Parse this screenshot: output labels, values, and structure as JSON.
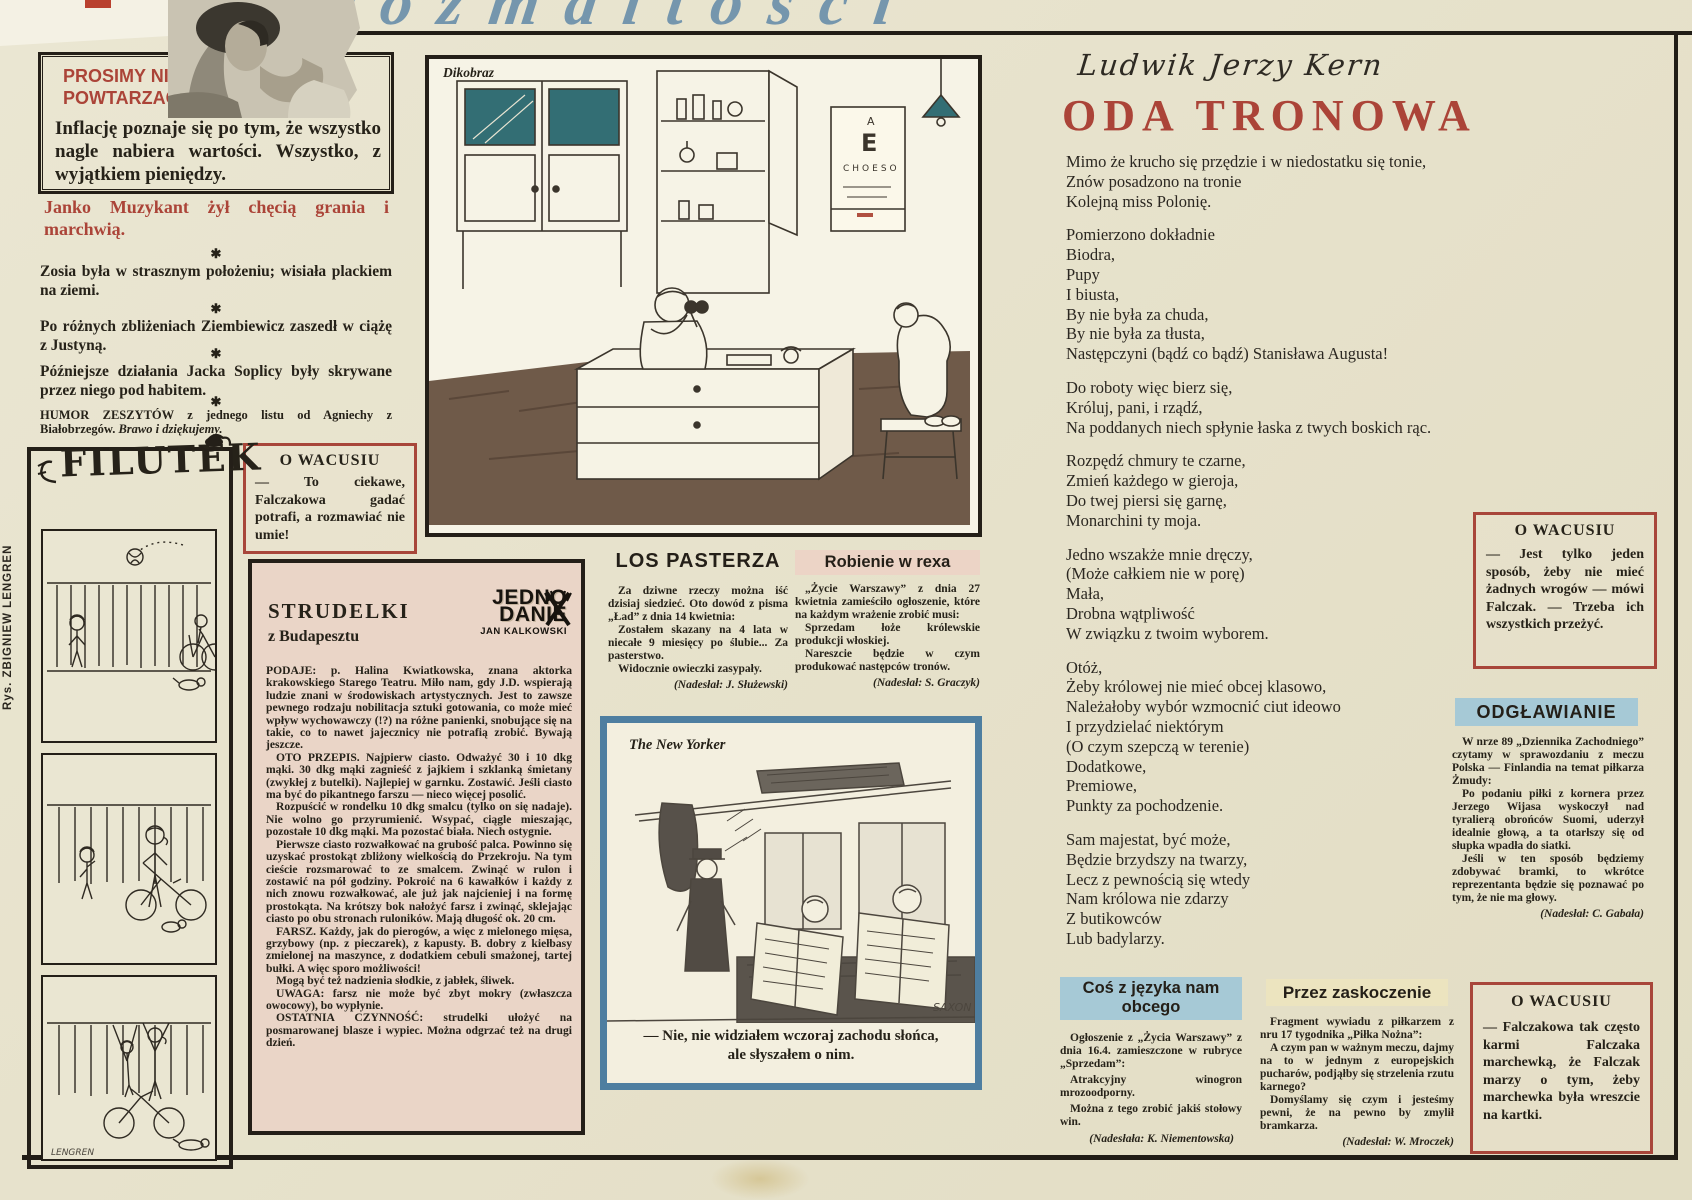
{
  "masthead": {
    "script": "rozmaitości"
  },
  "prosimy": {
    "title_line1": "PROSIMY NIE",
    "title_line2": "POWTARZAĆ.",
    "body": "Inflację poznaje się po tym, że wszystko nagle nabiera wartości. Wszystko, z wyjątkiem pieniędzy."
  },
  "janko": {
    "text": "Janko Muzykant żył chęcią grania i marchwią."
  },
  "aphorisms": {
    "separator": "✱",
    "items": [
      "Zosia była w strasznym położeniu; wisiała plackiem na ziemi.",
      "Po różnych zbliżeniach Ziembiewicz zaszedł w ciążę z Justyną.",
      "Późniejsze działania Jacka Soplicy były skrywane przez niego pod habitem."
    ]
  },
  "humor": {
    "text_bold": "HUMOR ZESZYTÓW z jednego listu od Agniechy z Białobrzegów.",
    "text_italic": "Brawo i dziękujemy."
  },
  "wacusiu1": {
    "title": "O WACUSIU",
    "body": "— To ciekawe, Falczakowa gadać potrafi, a rozmawiać nie umie!"
  },
  "filutek": {
    "logo": "FILUTEK",
    "artist": "Rys. ZBIGNIEW LENGREN",
    "signature": "LENGREN"
  },
  "strudelki": {
    "title": "STRUDELKI",
    "subtitle": "z Budapesztu",
    "logo_line1": "JEDNO",
    "logo_line2": "DANIE",
    "logo_byline": "JAN KALKOWSKI",
    "paragraphs": [
      "PODAJE: p. Halina Kwiatkowska, znana aktorka krakowskiego Starego Teatru. Miło nam, gdy J.D. wspierają ludzie znani w środowiskach artystycznych. Jest to zawsze pewnego rodzaju nobilitacja sztuki gotowania, co może mieć wpływ wychowawczy (!?) na różne panienki, snobujące się na takie, co to nawet jajecznicy nie potrafią zrobić. Bywają jeszcze.",
      "OTO PRZEPIS. Najpierw ciasto. Odważyć 30 i 10 dkg mąki. 30 dkg mąki zagnieść z jajkiem i szklanką śmietany (zwykłej z butelki). Najlepiej w garnku. Zostawić. Jeśli ciasto ma być do pikantnego farszu — nieco więcej posolić.",
      "Rozpuścić w rondelku 10 dkg smalcu (tylko on się nadaje). Nie wolno go przyrumienić. Wsypać, ciągle mieszając, pozostałe 10 dkg mąki. Ma pozostać biała. Niech ostygnie.",
      "Pierwsze ciasto rozwałkować na grubość palca. Powinno się uzyskać prostokąt zbliżony wielkością do Przekroju. Na tym cieście rozsmarować to ze smalcem. Zwinąć w rulon i zostawić na pół godziny. Pokroić na 6 kawałków i każdy z nich znowu rozwałkować, ale już jak najcieniej i na formę prostokąta. Na krótszy bok nałożyć farsz i zwinąć, sklejając ciasto po obu stronach ruloników. Mają długość ok. 20 cm.",
      "FARSZ. Każdy, jak do pierogów, a więc z mielonego mięsa, grzybowy (np. z pieczarek), z kapusty. B. dobry z kiełbasy zmielonej na maszynce, z dodatkiem cebuli smażonej, tartej bułki. A więc sporo możliwości!",
      "Mogą być też nadzienia słodkie, z jabłek, śliwek.",
      "UWAGA: farsz nie może być zbyt mokry (zwłaszcza owocowy), bo wypłynie.",
      "OSTATNIA CZYNNOŚĆ: strudelki ułożyć na posmarowanej blasze i wypiec. Można odgrzać też na drugi dzień."
    ]
  },
  "dikobraz": {
    "label": "Dikobraz",
    "eyechart_row1": "A",
    "eyechart_row2": "E",
    "eyechart_row3": "CHOESO"
  },
  "los_pasterza": {
    "title": "LOS PASTERZA",
    "p1": "Za dziwne rzeczy można iść dzisiaj siedzieć. Oto dowód z pisma „Ład” z dnia 14 kwietnia:",
    "p2": "Zostałem skazany na 4 lata w niecałe 9 miesięcy po ślubie... Za pasterstwo.",
    "p3": "Widocznie owieczki zasypały.",
    "credit": "(Nadesłał: J. Służewski)"
  },
  "robienie": {
    "title": "Robienie w rexa",
    "p1": "„Życie Warszawy” z dnia 27 kwietnia zamieściło ogłoszenie, które na każdym wrażenie zrobić musi:",
    "p2": "Sprzedam łoże królewskie produkcji włoskiej.",
    "p3": "Nareszcie będzie w czym produkować następców tronów.",
    "credit": "(Nadesłał: S. Graczyk)"
  },
  "new_yorker": {
    "label": "The New Yorker",
    "caption": "— Nie, nie widziałem wczoraj zachodu słońca, ale słyszałem o nim.",
    "signature": "SAXON"
  },
  "oda": {
    "author": "Ludwik Jerzy Kern",
    "title": "ODA TRONOWA",
    "stanzas": [
      "Mimo że krucho się przędzie i w niedostatku się tonie,\nZnów posadzono na tronie\nKolejną miss Polonię.",
      "Pomierzono dokładnie\nBiodra,\nPupy\nI biusta,\nBy nie była za chuda,\nBy nie była za tłusta,\nNastępczyni (bądź co bądź) Stanisława Augusta!",
      "Do roboty więc bierz się,\nKróluj, pani, i rządź,\nNa poddanych niech spłynie łaska z twych boskich rąc.",
      "Rozpędź chmury te czarne,\nZmień każdego w gieroja,\nDo twej piersi się garnę,\nMonarchini ty moja.",
      "Jedno wszakże mnie dręczy,\n(Może całkiem nie w porę)\nMała,\nDrobna wątpliwość\nW związku z twoim wyborem.",
      "Otóż,\nŻeby królowej nie mieć obcej klasowo,\nNależałoby wybór wzmocnić ciut ideowo\nI przydzielać niektórym\n(O czym szepczą w terenie)\nDodatkowe,\nPremiowe,\nPunkty za pochodzenie.",
      "Sam majestat, być może,\nBędzie brzydszy na twarzy,\nLecz z pewnością się wtedy\nNam królowa nie zdarzy\nZ butikowców\nLub badylarzy."
    ]
  },
  "wacusiu2": {
    "title": "O WACUSIU",
    "body": "— Jest tylko jeden sposób, żeby nie mieć żadnych wrogów — mówi Falczak. — Trzeba ich wszystkich przeżyć."
  },
  "odglawianie": {
    "title": "ODGŁAWIANIE",
    "p1": "W nrze 89 „Dziennika Zachodniego” czytamy w sprawozdaniu z meczu Polska — Finlandia na temat piłkarza Żmudy:",
    "p2": "Po podaniu piłki z kornera przez Jerzego Wijasa wyskoczył nad tyralierą obrońców Suomi, uderzył idealnie głową, a ta otarłszy się od słupka wpadła do siatki.",
    "p3": "Jeśli w ten sposób będziemy zdobywać bramki, to wkrótce reprezentanta będzie się poznawać po tym, że nie ma głowy.",
    "credit": "(Nadesłał: C. Gabała)"
  },
  "cos_obcego": {
    "title_line1": "Coś z języka nam",
    "title_line2": "obcego",
    "p1": "Ogłoszenie z „Życia Warszawy” z dnia 16.4. zamieszczone w rubryce „Sprzedam”:",
    "p2": "Atrakcyjny winogron mrozoodporny.",
    "p3": "Można z tego zrobić jakiś stołowy win.",
    "credit": "(Nadesłała: K. Niementowska)"
  },
  "przez": {
    "title": "Przez zaskoczenie",
    "p1": "Fragment wywiadu z piłkarzem z nru 17 tygodnika „Piłka Nożna”:",
    "p2": "A czym pan w ważnym meczu, dajmy na to w jednym z europejskich pucharów, podjąłby się strzelenia rzutu karnego?",
    "p3": "Domyślamy się czym i jesteśmy pewni, że na pewno by zmylił bramkarza.",
    "credit": "(Nadesłał: W. Mroczek)"
  },
  "wacusiu3": {
    "title": "O WACUSIU",
    "body": "— Falczakowa tak często karmi Falczaka marchewką, że Falczak marzy o tym, żeby marchewka była wreszcie na kartki."
  },
  "colors": {
    "accent_red": "#a8463a",
    "header_blue": "#a6c9d6",
    "header_pink": "#ecd4c6",
    "header_cream": "#ece4bf",
    "frame_blue": "#4e7ea0",
    "script_blue": "#7596ad"
  }
}
